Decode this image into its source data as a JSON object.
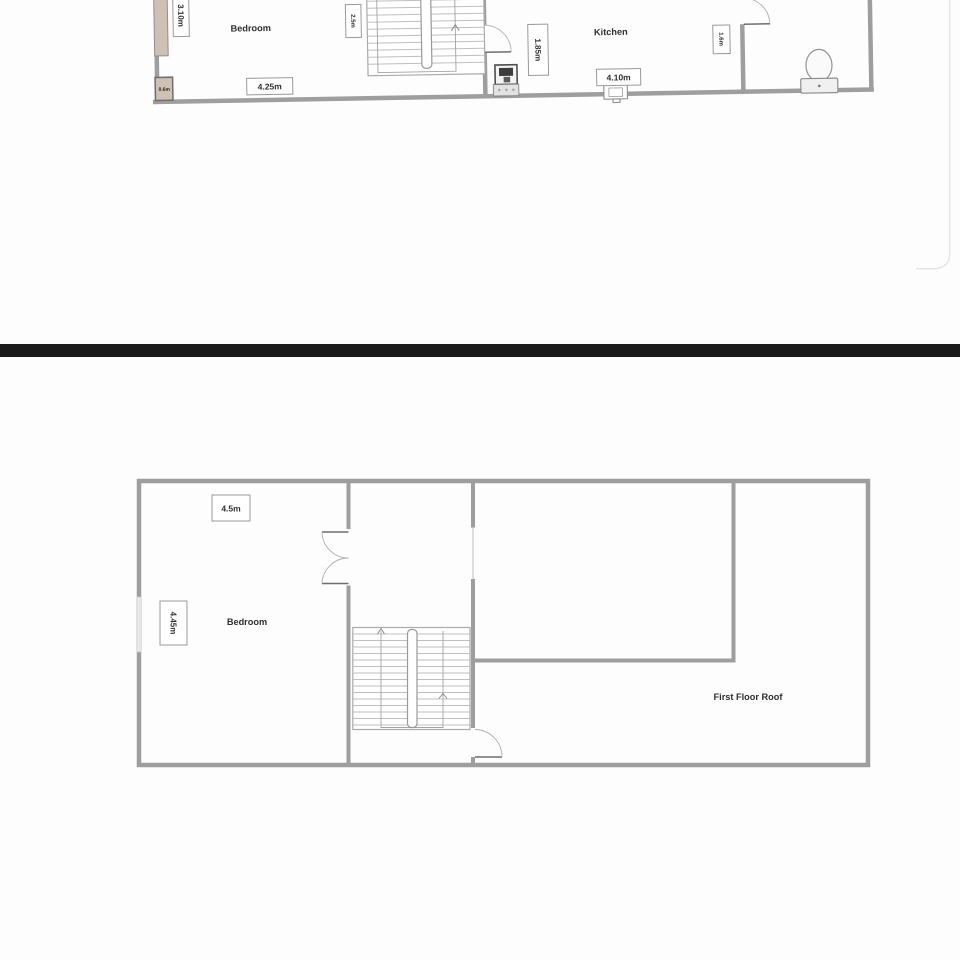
{
  "upper_plan": {
    "rooms": {
      "bedroom": "Bedroom",
      "kitchen": "Kitchen"
    },
    "dims": {
      "bedroom_height": "3.10m",
      "cupboard": "0.6m",
      "bedroom_width": "4.25m",
      "stairs": "2.5m",
      "kitchen_height": "1.85m",
      "kitchen_width": "4.10m",
      "wc": "1.6m"
    },
    "fixtures": [
      "staircase-icon",
      "door-icon",
      "boiler-icon",
      "sink-icon",
      "toilet-icon",
      "window-icon"
    ]
  },
  "lower_plan": {
    "rooms": {
      "bedroom": "Bedroom",
      "roof": "First Floor Roof"
    },
    "dims": {
      "bedroom_width": "4.5m",
      "bedroom_height": "4.45m"
    },
    "fixtures": [
      "staircase-icon",
      "double-door-icon",
      "door-icon",
      "window-icon"
    ]
  },
  "colors": {
    "wall": "#9e9e9e",
    "stair_tread": "#bfbfbf",
    "window_fill": "#cec1b4",
    "divider_bar": "#1b1b1b",
    "label_text": "#2e2e2e",
    "dim_border": "#9a9a9a",
    "page_edge": "#e3e3e3",
    "background": "#fdfdfd"
  }
}
